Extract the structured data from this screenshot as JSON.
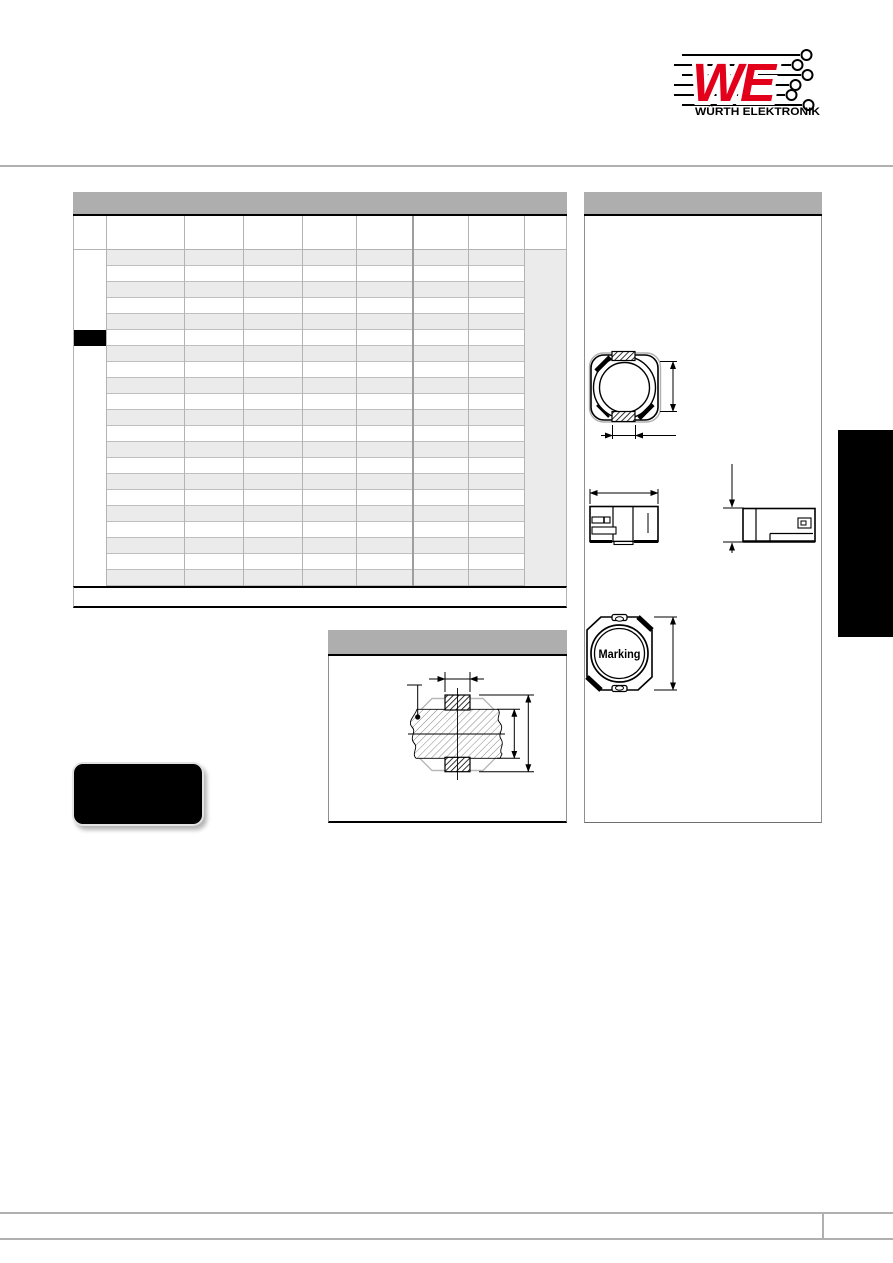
{
  "logo": {
    "we": "WE",
    "caption": "WÜRTH ELEKTRONIK",
    "brand_red": "#e2001a"
  },
  "sections": {
    "table_title": "",
    "dimensions_title": "",
    "land_pattern_title": ""
  },
  "table": {
    "column_count": 8,
    "row_count": 21,
    "highlighted_row": 6,
    "footer_note": ""
  },
  "marking": {
    "label": "Marking"
  },
  "badge": {
    "label": ""
  },
  "colors": {
    "bar_gray": "#aeaeae",
    "row_shade": "#ebebeb",
    "grid_gray": "#b3b3b3",
    "rule_gray": "#b0b0b0",
    "black": "#000000",
    "brand_red": "#e2001a"
  }
}
